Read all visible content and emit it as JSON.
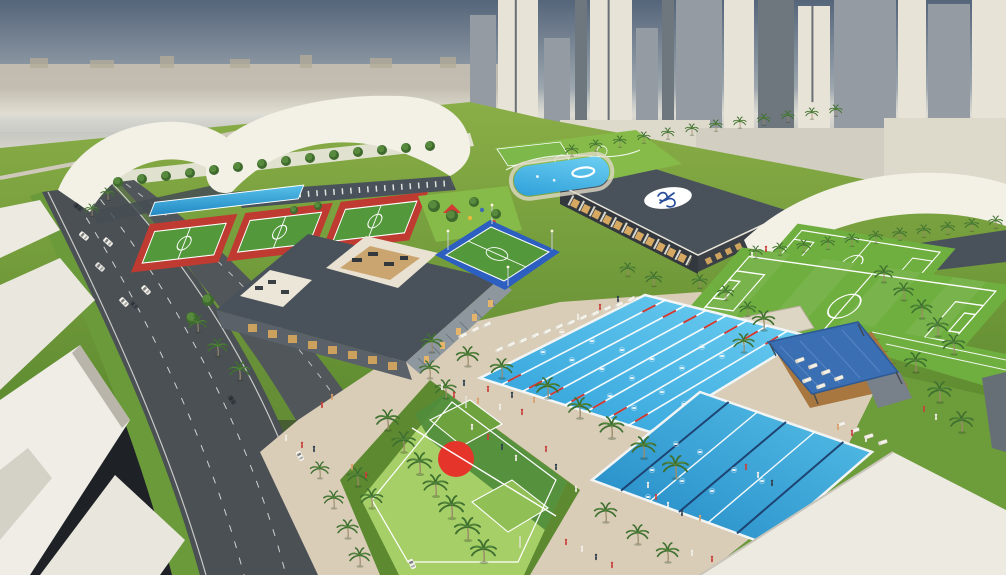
{
  "meta": {
    "title": "Aerial architectural rendering of a sports and aquatics complex",
    "type": "3d-render",
    "features": [
      "city-skyline",
      "highway",
      "white-tent-halls",
      "red-mini-pitches",
      "fitness-club-courtyards",
      "clubhouse-logo-roof",
      "leisure-pool",
      "olympic-pool",
      "training-pool",
      "basketball-court",
      "soccer-fields",
      "blue-shade-canopy",
      "palm-trees",
      "sunloungers",
      "pedestrians",
      "cars"
    ]
  },
  "colors": {
    "sky_top": "#55657a",
    "sky_mid": "#97a2ab",
    "sky_horizon": "#d6d4cb",
    "haze": "#e3e0d6",
    "distant_city": "#c6c0b0",
    "grass": "#79a23c",
    "grass_dark": "#5d8a30",
    "lawn_bright": "#86bb49",
    "field_green": "#6faf3f",
    "field_line": "#ffffff",
    "court_red": "#bf3b31",
    "court_green": "#53993c",
    "court_blue": "#2d5fc0",
    "court_light": "#9ccb5f",
    "court_dark": "#4f8c3b",
    "center_red": "#e5352b",
    "pool_blue": "#2d9fd9",
    "pool_light": "#45bcd6",
    "lane_red": "#d0372f",
    "lane_navy": "#1c3f6e",
    "deck": "#d9cdb8",
    "deck_light": "#e4dbc9",
    "roof_white": "#eceae1",
    "roof_shade": "#b9b5aa",
    "tent_white": "#f3f0e6",
    "wall_dark": "#49525a",
    "wall_darker": "#343b42",
    "louver": "#8f979e",
    "glass_warm": "#dfae63",
    "road": "#4b5055",
    "road_line": "#e8e8e4",
    "verge": "#6b9a3b",
    "palm_green": "#3f7030",
    "palm_trunk": "#9b8a6b",
    "canopy_blue": "#3b6fb3",
    "wood": "#a8763f",
    "skyline_lit": "#e7e3d6",
    "skyline_shade": "#949ba3",
    "skyline_dark": "#6e767e",
    "skyline_pale": "#ddd9cb",
    "skyline_pale2": "#d2cfc2",
    "logo_blue": "#2a4d9b",
    "white": "#ffffff"
  },
  "scene": {
    "towers": [
      [
        470,
        15,
        26,
        195,
        "shade",
        0
      ],
      [
        498,
        0,
        40,
        212,
        "lit",
        1
      ],
      [
        544,
        38,
        26,
        165,
        "shade",
        0
      ],
      [
        575,
        0,
        12,
        150,
        "dark",
        0
      ],
      [
        590,
        0,
        42,
        195,
        "lit",
        1
      ],
      [
        636,
        28,
        22,
        150,
        "shade",
        0
      ],
      [
        662,
        0,
        12,
        160,
        "dark",
        0
      ],
      [
        676,
        0,
        46,
        165,
        "shade",
        0
      ],
      [
        724,
        0,
        30,
        130,
        "lit",
        0
      ],
      [
        758,
        0,
        36,
        150,
        "dark",
        0
      ],
      [
        798,
        6,
        32,
        155,
        "lit",
        1
      ],
      [
        834,
        0,
        62,
        140,
        "shade",
        0
      ],
      [
        898,
        0,
        28,
        130,
        "lit",
        0
      ],
      [
        928,
        4,
        42,
        140,
        "shade",
        0
      ],
      [
        972,
        0,
        34,
        150,
        "lit",
        0
      ],
      [
        560,
        120,
        150,
        58,
        "pale",
        0
      ],
      [
        696,
        128,
        210,
        66,
        "pale2",
        0
      ],
      [
        884,
        118,
        122,
        72,
        "pale",
        0
      ]
    ],
    "pools": [
      {
        "name": "olympic-pool",
        "corners": [
          [
            480,
            378
          ],
          [
            645,
            295
          ],
          [
            808,
            336
          ],
          [
            650,
            432
          ]
        ],
        "lanes": 8,
        "style": "white-red"
      },
      {
        "name": "training-pool",
        "corners": [
          [
            592,
            480
          ],
          [
            700,
            392
          ],
          [
            872,
            452
          ],
          [
            766,
            544
          ]
        ],
        "lanes": 6,
        "style": "navy-white"
      }
    ],
    "swimmers1": [
      [
        543,
        352
      ],
      [
        572,
        360
      ],
      [
        602,
        369
      ],
      [
        632,
        378
      ],
      [
        562,
        332
      ],
      [
        592,
        341
      ],
      [
        622,
        350
      ],
      [
        652,
        359
      ],
      [
        682,
        368
      ],
      [
        702,
        347
      ],
      [
        722,
        356
      ],
      [
        744,
        342
      ],
      [
        662,
        392
      ],
      [
        634,
        408
      ],
      [
        610,
        396
      ],
      [
        684,
        404
      ]
    ],
    "swimmers2": [
      [
        652,
        470
      ],
      [
        682,
        481
      ],
      [
        712,
        491
      ],
      [
        734,
        470
      ],
      [
        762,
        481
      ],
      [
        700,
        452
      ],
      [
        676,
        444
      ],
      [
        648,
        497
      ]
    ],
    "palms": [
      [
        320,
        478,
        0.8
      ],
      [
        334,
        508,
        0.85
      ],
      [
        348,
        538,
        0.9
      ],
      [
        360,
        566,
        0.9
      ],
      [
        388,
        430,
        1.0
      ],
      [
        404,
        452,
        1.0
      ],
      [
        420,
        474,
        1.05
      ],
      [
        436,
        496,
        1.05
      ],
      [
        452,
        518,
        1.1
      ],
      [
        468,
        540,
        1.1
      ],
      [
        484,
        562,
        1.1
      ],
      [
        372,
        508,
        0.95
      ],
      [
        358,
        486,
        0.9
      ],
      [
        446,
        398,
        0.9
      ],
      [
        430,
        378,
        0.85
      ],
      [
        432,
        352,
        0.9
      ],
      [
        468,
        366,
        0.95
      ],
      [
        502,
        378,
        0.95
      ],
      [
        548,
        398,
        1.0
      ],
      [
        580,
        418,
        1.0
      ],
      [
        612,
        438,
        1.05
      ],
      [
        644,
        458,
        1.05
      ],
      [
        676,
        478,
        1.1
      ],
      [
        606,
        522,
        0.95
      ],
      [
        638,
        544,
        0.95
      ],
      [
        668,
        562,
        0.95
      ],
      [
        572,
        156,
        0.55
      ],
      [
        596,
        151,
        0.55
      ],
      [
        620,
        147,
        0.55
      ],
      [
        644,
        143,
        0.55
      ],
      [
        668,
        139,
        0.55
      ],
      [
        692,
        135,
        0.55
      ],
      [
        716,
        131,
        0.55
      ],
      [
        740,
        128,
        0.55
      ],
      [
        764,
        125,
        0.55
      ],
      [
        788,
        122,
        0.55
      ],
      [
        812,
        119,
        0.55
      ],
      [
        836,
        116,
        0.55
      ],
      [
        756,
        258,
        0.6
      ],
      [
        780,
        255,
        0.6
      ],
      [
        804,
        252,
        0.6
      ],
      [
        828,
        249,
        0.6
      ],
      [
        852,
        246,
        0.6
      ],
      [
        876,
        243,
        0.6
      ],
      [
        900,
        240,
        0.6
      ],
      [
        924,
        237,
        0.6
      ],
      [
        948,
        234,
        0.6
      ],
      [
        972,
        231,
        0.6
      ],
      [
        996,
        228,
        0.6
      ],
      [
        884,
        282,
        0.8
      ],
      [
        904,
        300,
        0.85
      ],
      [
        922,
        318,
        0.9
      ],
      [
        938,
        336,
        0.9
      ],
      [
        954,
        354,
        0.95
      ],
      [
        764,
        330,
        0.95
      ],
      [
        744,
        352,
        0.9
      ],
      [
        916,
        372,
        0.95
      ],
      [
        940,
        402,
        1.0
      ],
      [
        962,
        432,
        1.0
      ],
      [
        218,
        356,
        0.85
      ],
      [
        240,
        380,
        0.9
      ],
      [
        198,
        332,
        0.8
      ],
      [
        108,
        200,
        0.6
      ],
      [
        92,
        216,
        0.6
      ],
      [
        726,
        300,
        0.7
      ],
      [
        748,
        316,
        0.7
      ],
      [
        700,
        288,
        0.65
      ],
      [
        654,
        286,
        0.7
      ],
      [
        628,
        276,
        0.65
      ]
    ],
    "trees": [
      [
        118,
        182,
        5
      ],
      [
        142,
        179,
        5
      ],
      [
        166,
        176,
        5
      ],
      [
        190,
        173,
        5
      ],
      [
        214,
        170,
        5
      ],
      [
        238,
        167,
        5
      ],
      [
        262,
        164,
        5
      ],
      [
        286,
        161,
        5
      ],
      [
        310,
        158,
        5
      ],
      [
        334,
        155,
        5
      ],
      [
        358,
        152,
        5
      ],
      [
        382,
        150,
        5
      ],
      [
        406,
        148,
        5
      ],
      [
        430,
        146,
        5
      ],
      [
        434,
        206,
        6
      ],
      [
        452,
        216,
        6
      ],
      [
        474,
        202,
        5
      ],
      [
        496,
        214,
        5
      ],
      [
        208,
        300,
        6
      ],
      [
        192,
        318,
        6
      ],
      [
        294,
        210,
        4
      ],
      [
        318,
        206,
        4
      ]
    ],
    "people_colors": [
      "#c8413b",
      "#f2efe8",
      "#30414f",
      "#d9a06b",
      "#3c6cb4"
    ],
    "people": [
      [
        302,
        448,
        0
      ],
      [
        314,
        452,
        2
      ],
      [
        286,
        441,
        1
      ],
      [
        352,
        470,
        3
      ],
      [
        366,
        478,
        0
      ],
      [
        442,
        390,
        1
      ],
      [
        454,
        398,
        0
      ],
      [
        464,
        386,
        2
      ],
      [
        478,
        404,
        3
      ],
      [
        488,
        392,
        0
      ],
      [
        500,
        410,
        1
      ],
      [
        512,
        398,
        2
      ],
      [
        522,
        415,
        0
      ],
      [
        534,
        403,
        3
      ],
      [
        472,
        430,
        1
      ],
      [
        488,
        440,
        0
      ],
      [
        502,
        450,
        2
      ],
      [
        516,
        461,
        1
      ],
      [
        656,
        500,
        0
      ],
      [
        668,
        508,
        1
      ],
      [
        682,
        516,
        2
      ],
      [
        700,
        521,
        3
      ],
      [
        648,
        488,
        1
      ],
      [
        746,
        470,
        0
      ],
      [
        758,
        478,
        1
      ],
      [
        772,
        486,
        2
      ],
      [
        838,
        430,
        3
      ],
      [
        852,
        436,
        0
      ],
      [
        866,
        442,
        1
      ],
      [
        566,
        545,
        0
      ],
      [
        582,
        552,
        1
      ],
      [
        596,
        560,
        2
      ],
      [
        612,
        568,
        0
      ],
      [
        692,
        556,
        1
      ],
      [
        712,
        562,
        0
      ],
      [
        556,
        470,
        2
      ],
      [
        546,
        452,
        0
      ],
      [
        576,
        492,
        1
      ],
      [
        578,
        320,
        1
      ],
      [
        600,
        310,
        0
      ],
      [
        618,
        302,
        2
      ],
      [
        332,
        400,
        3
      ],
      [
        322,
        408,
        0
      ],
      [
        752,
        258,
        1
      ],
      [
        766,
        252,
        0
      ],
      [
        924,
        412,
        0
      ],
      [
        936,
        420,
        1
      ]
    ],
    "cars": [
      [
        78,
        207,
        -52,
        "#3a4148"
      ],
      [
        84,
        236,
        -50,
        "#f4f2ec"
      ],
      [
        108,
        242,
        -48,
        "#f4f2ec"
      ],
      [
        100,
        267,
        -48,
        "#e8e6e0"
      ],
      [
        146,
        290,
        -44,
        "#f4f2ec"
      ],
      [
        124,
        302,
        -44,
        "#f4f2ec"
      ],
      [
        134,
        305,
        -44,
        "#454b52"
      ],
      [
        232,
        400,
        -34,
        "#3a4148"
      ],
      [
        300,
        456,
        -30,
        "#f4f2ec"
      ],
      [
        412,
        564,
        -26,
        "#f7f5ef"
      ]
    ],
    "loungers": [
      [
        494,
        350,
        -27
      ],
      [
        506,
        345,
        -27
      ],
      [
        518,
        341,
        -27
      ],
      [
        530,
        336,
        -27
      ],
      [
        542,
        332,
        -27
      ],
      [
        554,
        327,
        -27
      ],
      [
        566,
        323,
        -27
      ],
      [
        578,
        318,
        -27
      ],
      [
        590,
        314,
        -27
      ],
      [
        602,
        309,
        -27
      ],
      [
        614,
        305,
        -27
      ],
      [
        626,
        300,
        -27
      ],
      [
        458,
        336,
        -27
      ],
      [
        470,
        330,
        -27
      ],
      [
        482,
        325,
        -27
      ],
      [
        795,
        360,
        -20
      ],
      [
        808,
        366,
        -20
      ],
      [
        821,
        372,
        -20
      ],
      [
        834,
        378,
        -20
      ],
      [
        802,
        380,
        -20
      ],
      [
        816,
        386,
        -20
      ],
      [
        836,
        424,
        -18
      ],
      [
        850,
        430,
        -18
      ],
      [
        864,
        436,
        -18
      ],
      [
        878,
        442,
        -18
      ]
    ]
  }
}
